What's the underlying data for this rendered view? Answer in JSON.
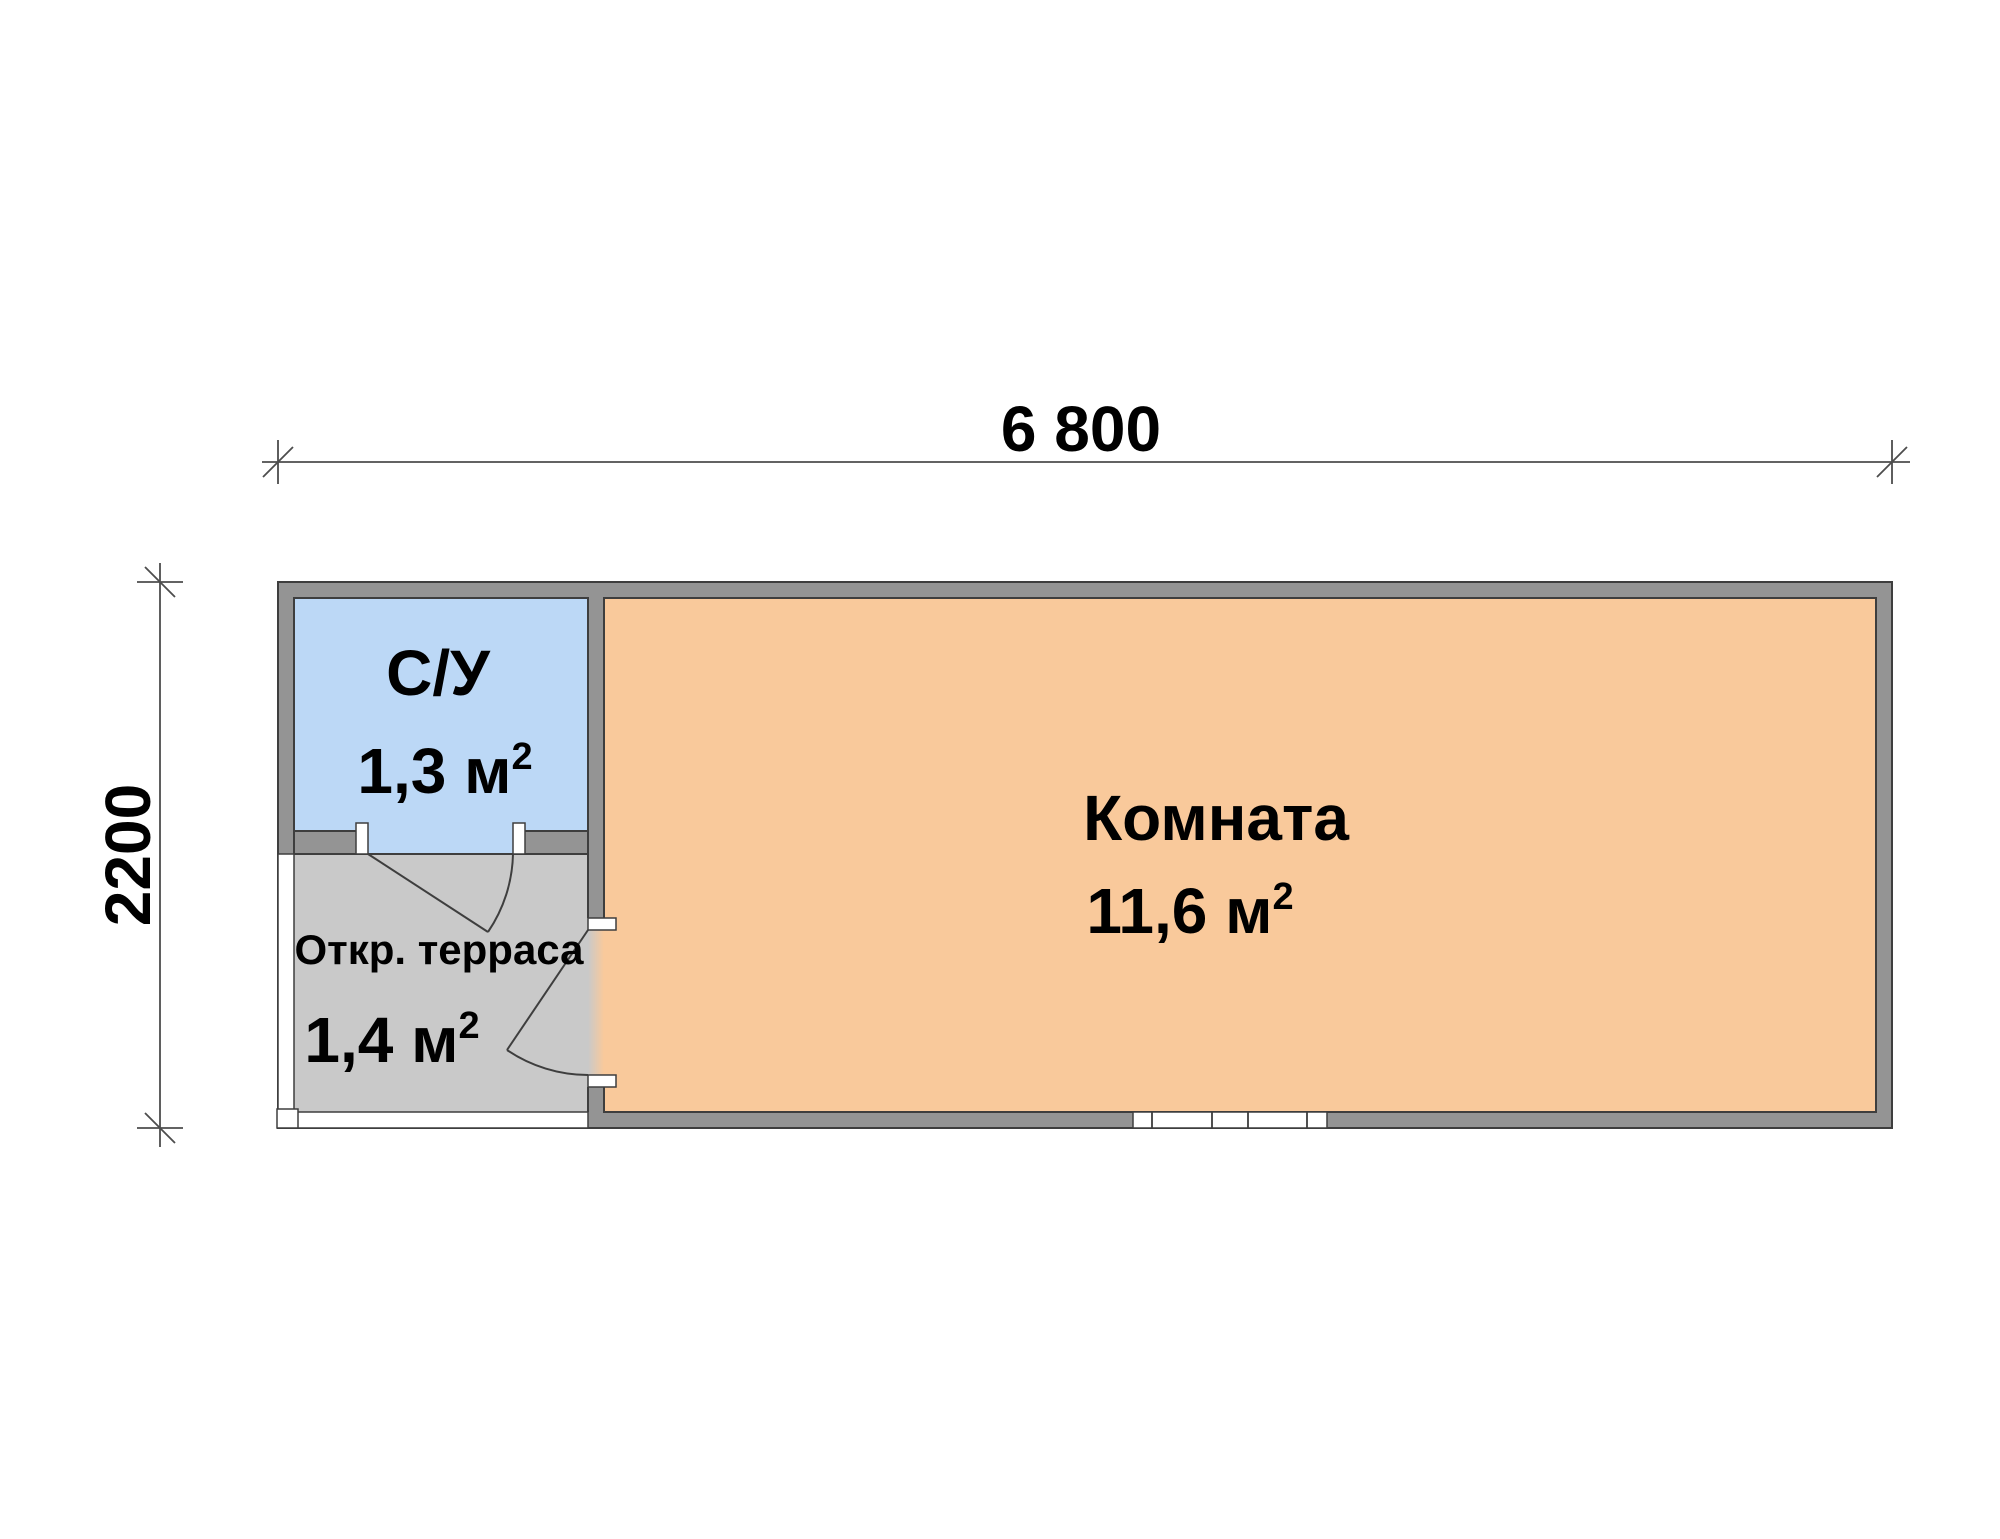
{
  "drawing": {
    "type": "floor-plan",
    "dimensions": {
      "width_label": "6 800",
      "height_label": "2200"
    },
    "rooms": {
      "bathroom": {
        "name": "С/У",
        "area": "1,3 м",
        "area_sup": "2"
      },
      "terrace": {
        "name": "Откр. терраса",
        "area": "1,4 м",
        "area_sup": "2"
      },
      "room": {
        "name": "Комната",
        "area": "11,6 м",
        "area_sup": "2"
      }
    },
    "colors": {
      "bathroom_fill": "#BCD8F6",
      "room_fill": "#F9C99B",
      "terrace_fill": "#C9C9C9",
      "wall_fill": "#949494",
      "outline": "#3E3E3E",
      "dimension": "#4D4D4D",
      "white": "#FFFFFF"
    }
  }
}
